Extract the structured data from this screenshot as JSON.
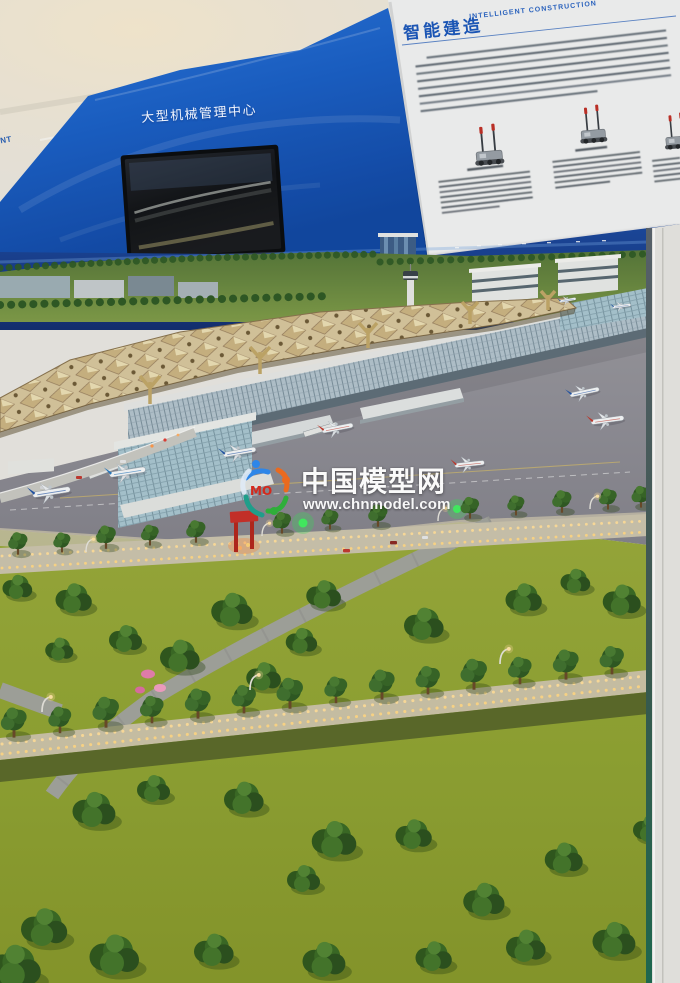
{
  "board": {
    "machinery_center_label": "大型机械管理中心",
    "partial_edge_label": "ANT"
  },
  "info_panel": {
    "title_cn": "智能建造",
    "title_en": "INTELLIGENT CONSTRUCTION"
  },
  "watermark": {
    "logo_text": "MO",
    "site_name": "中国模型网",
    "site_url": "www.chnmodel.com"
  },
  "colors": {
    "panel_blue": "#1a63cf",
    "backdrop_navy": "#16357e",
    "canopy_beige": "#d8c79f",
    "grass_green": "#93a83a",
    "apron_gray": "#8d8c95",
    "warm_light": "#ffd98a",
    "title_blue": "#1b55b4",
    "watermark_white": "#ffffff",
    "glass_edge_teal": "#1e6b52"
  }
}
